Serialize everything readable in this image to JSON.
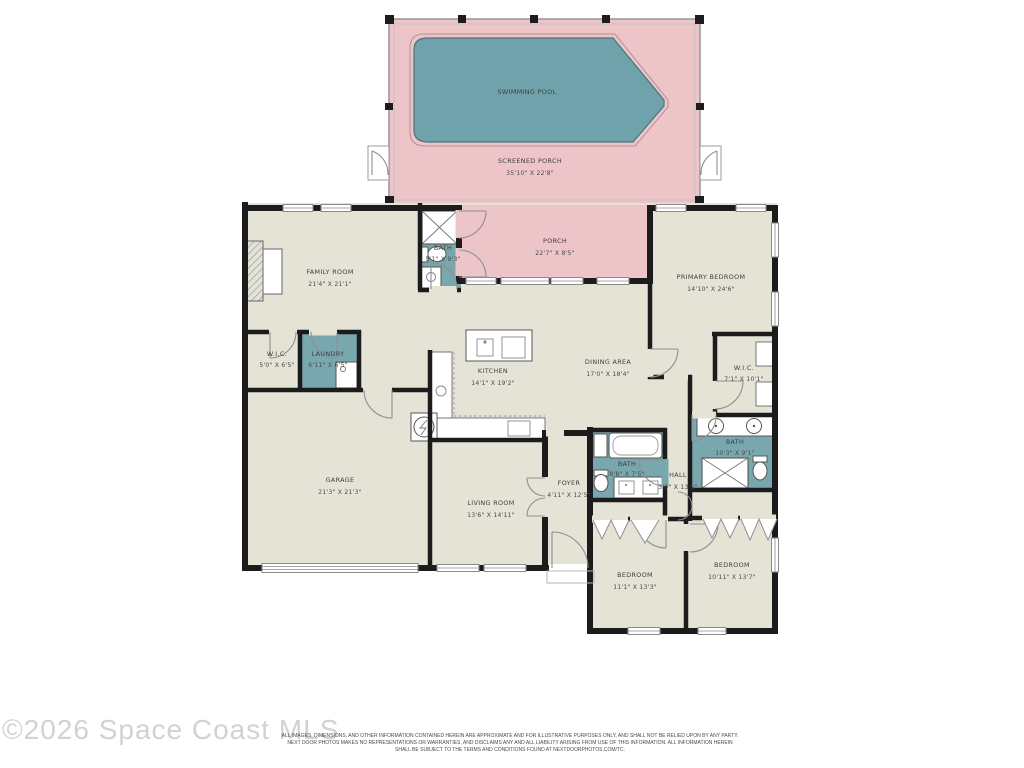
{
  "colors": {
    "floor": "#e4e3d6",
    "porch_pink": "#edc4c8",
    "pool_water": "#6fa2ab",
    "bath_teal": "#79a7ae",
    "wall_black": "#1c1c1c",
    "label_text": "#3e3e3e",
    "watermark_grey": "#d2d2d2"
  },
  "rooms": [
    {
      "id": "swimming-pool",
      "name": "SWIMMING POOL",
      "dims": ""
    },
    {
      "id": "screened-porch",
      "name": "SCREENED PORCH",
      "dims": "35'10\" X 22'8\""
    },
    {
      "id": "porch",
      "name": "PORCH",
      "dims": "22'7\" X 8'5\""
    },
    {
      "id": "family-room",
      "name": "FAMILY ROOM",
      "dims": "21'4\" X 21'1\""
    },
    {
      "id": "bath-1",
      "name": "BATH",
      "dims": "5'1\" X 9'3\""
    },
    {
      "id": "primary-bedroom",
      "name": "PRIMARY BEDROOM",
      "dims": "14'10\" X 24'6\""
    },
    {
      "id": "wic-1",
      "name": "W.I.C.",
      "dims": "5'0\" X 6'5\""
    },
    {
      "id": "laundry",
      "name": "LAUNDRY",
      "dims": "6'11\" X 6'5\""
    },
    {
      "id": "kitchen",
      "name": "KITCHEN",
      "dims": "14'1\" X 19'2\""
    },
    {
      "id": "dining-area",
      "name": "DINING AREA",
      "dims": "17'0\" X 18'4\""
    },
    {
      "id": "wic-2",
      "name": "W.I.C.",
      "dims": "7'1\" X 10'1\""
    },
    {
      "id": "bath-2",
      "name": "BATH",
      "dims": "10'3\" X 9'1\""
    },
    {
      "id": "garage",
      "name": "GARAGE",
      "dims": "21'3\" X 21'3\""
    },
    {
      "id": "living-room",
      "name": "LIVING ROOM",
      "dims": "13'6\" X 14'11\""
    },
    {
      "id": "foyer",
      "name": "FOYER",
      "dims": "4'11\" X 12'5\""
    },
    {
      "id": "bath-3",
      "name": "BATH",
      "dims": "8'8\" X 7'5\""
    },
    {
      "id": "hall",
      "name": "HALL",
      "dims": "3'9\" X 13'5\""
    },
    {
      "id": "bedroom-1",
      "name": "BEDROOM",
      "dims": "11'1\" X 13'3\""
    },
    {
      "id": "bedroom-2",
      "name": "BEDROOM",
      "dims": "10'11\" X 13'7\""
    }
  ],
  "footer": {
    "watermark": "©2026 Space Coast MLS",
    "disclaimer": [
      "ALL IMAGES, DIMENSIONS, AND OTHER INFORMATION CONTAINED HEREIN ARE APPROXIMATE AND FOR ILLUSTRATIVE PURPOSES ONLY, AND SHALL NOT BE RELIED UPON BY ANY PARTY.",
      "NEXT DOOR PHOTOS MAKES NO REPRESENTATIONS OR WARRANTIES, AND DISCLAIMS ANY AND ALL LIABILITY ARISING FROM USE OF THIS INFORMATION. ALL INFORMATION HEREIN",
      "SHALL BE SUBJECT TO THE TERMS AND CONDITIONS FOUND AT NEXTDOORPHOTOS.COM/TC."
    ]
  }
}
